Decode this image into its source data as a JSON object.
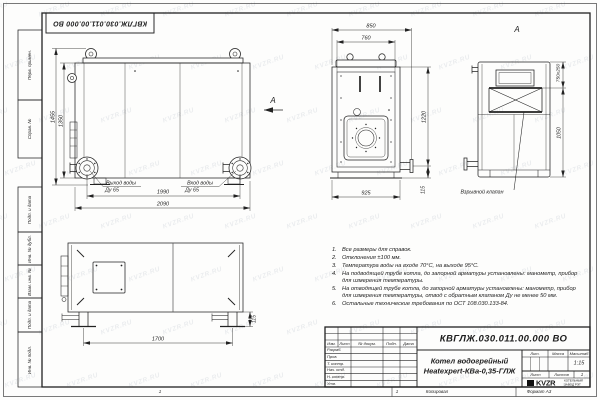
{
  "watermark": "KVZR.RU",
  "frame": {
    "left_labels": [
      "Перв. примен.",
      "Справ. №",
      "Подп. и дата",
      "Инв. № дубл.",
      "Взам. инв. №",
      "Подп. и дата",
      "Инв. № подл."
    ],
    "zone_number": "1",
    "copied_label": "Копировал",
    "format_label": "Формат А3"
  },
  "header_stamp": {
    "doc_number": "КВГЛЖ.030.011.00.000 ВО"
  },
  "views": {
    "front": {
      "dim_height_outer": "1455",
      "dim_height_inner": "1350",
      "dim_width_inner": "1990",
      "dim_width_outer": "2090",
      "outlet_label": "Выход воды",
      "outlet_dn": "Ду 65",
      "inlet_label": "Вход воды",
      "inlet_dn": "Ду 65",
      "section_arrow": "А"
    },
    "end": {
      "dim_top_outer": "850",
      "dim_top_inner": "760",
      "dim_height": "1220",
      "dim_stub_offset": "115",
      "dim_bottom": "925"
    },
    "view_a": {
      "label": "А",
      "dim_valve": "750x250",
      "dim_height": "1050",
      "valve_label": "Взрывной клапан"
    },
    "side": {
      "dim_width": "1700",
      "dim_foot": "115"
    }
  },
  "notes": [
    "Все размеры для справок.",
    "Отклонения ±100 мм.",
    "Температура воды на входе 70°С, на выходе 95°С.",
    "На подводящей трубе котла, до запорной арматуры установлены: манометр, прибор для измерения температуры.",
    "На отводящей трубе котла, до запорной арматуры установлены: манометр, прибор для измерения температуры, отвод с обратным клапаном Ду не менее 50 мм.",
    "Остальные технические требования по ОСТ 108.030.133-84."
  ],
  "title_block": {
    "doc_number": "КВГЛЖ.030.011.00.000 ВО",
    "rev_headers": [
      "Изм.",
      "Лист",
      "№ докум.",
      "Подп.",
      "Дата"
    ],
    "sign_rows": [
      "Разраб.",
      "Пров.",
      "Т. контр.",
      "Нач. отд.",
      "Н. контр.",
      "Утв."
    ],
    "product_line1": "Котел водогрейный",
    "product_line2": "Heatexpert-КВа-0,35-ГЛЖ",
    "lit_label": "Лит.",
    "mass_label": "Масса",
    "scale_label": "Масштаб",
    "scale_value": "1:15",
    "sheet_label": "Лист",
    "sheets_label": "Листов",
    "sheets_value": "1",
    "logo_text": "KVZR",
    "company_line1": "КОТЕЛЬНЫЙ",
    "company_line2": "ЗАВОД РЭТ"
  }
}
